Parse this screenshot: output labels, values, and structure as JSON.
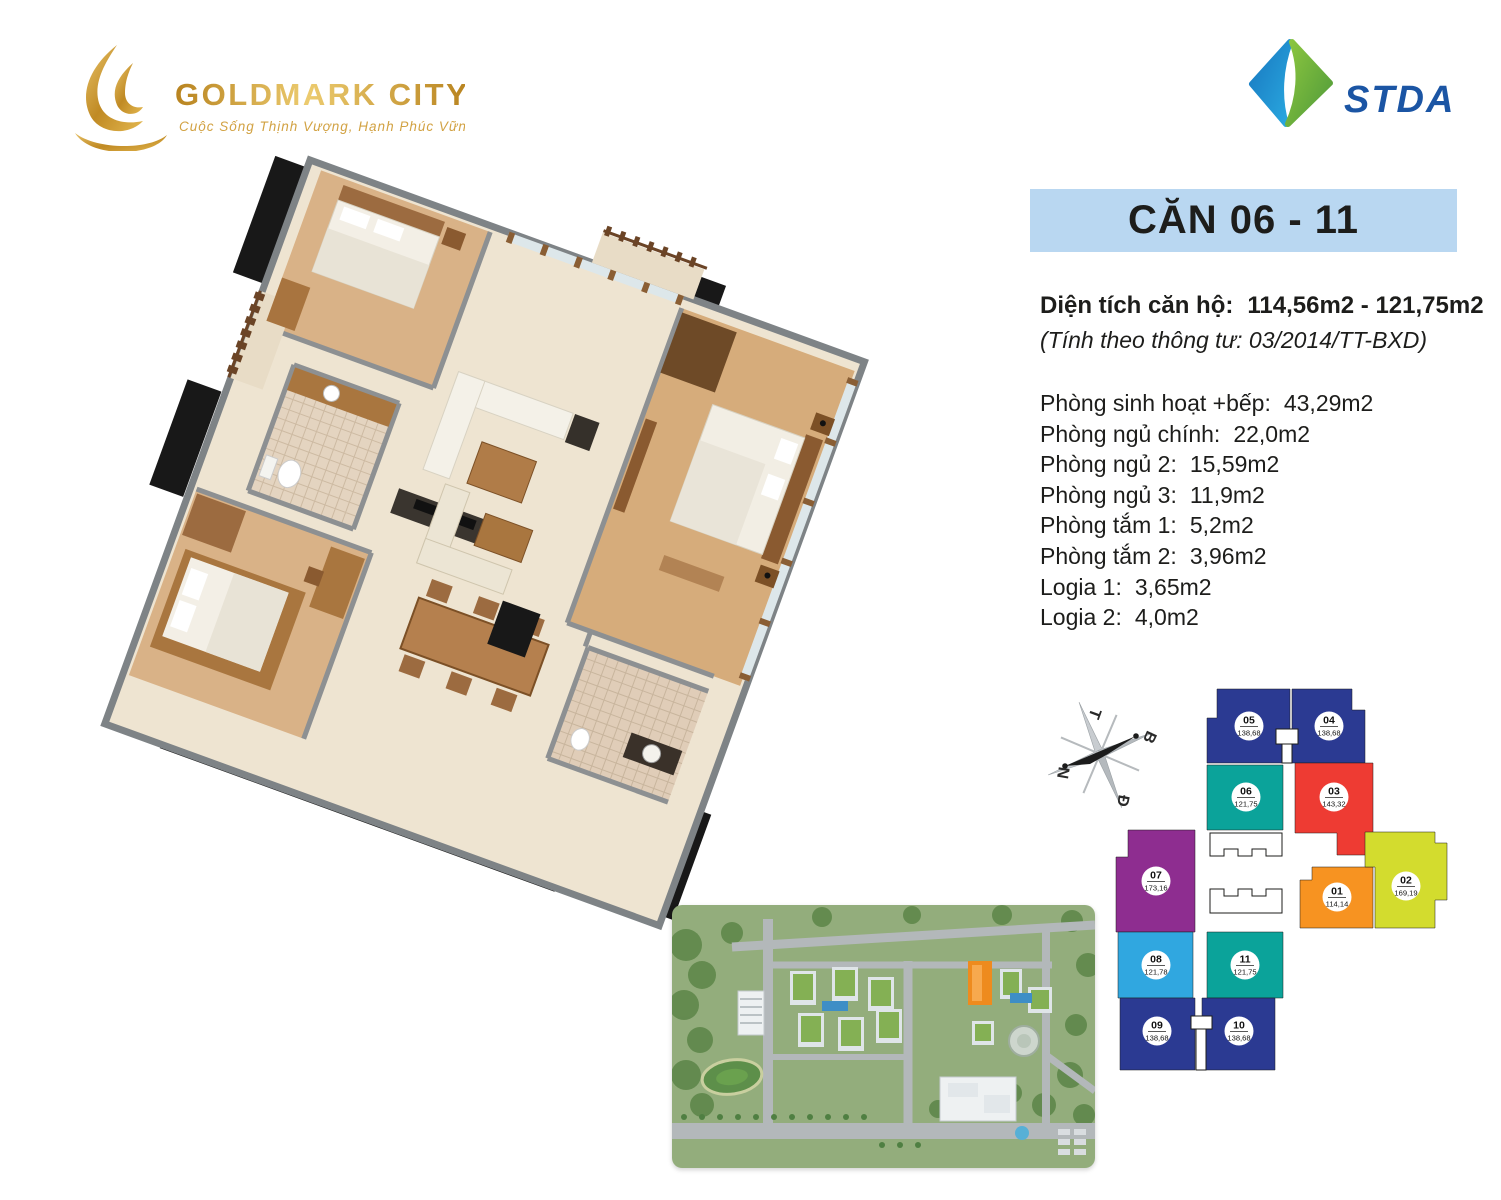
{
  "branding": {
    "goldmark": {
      "name": "GOLDMARK CITY",
      "tagline": "Cuộc Sống Thịnh Vượng, Hạnh Phúc Vững Bền",
      "gold": "#c9952c"
    },
    "stda": {
      "name": "STDA",
      "blue": "#1b55a4"
    }
  },
  "unit_header": {
    "title": "CĂN 06 - 11",
    "bg_color": "#b9d7f1"
  },
  "area_summary": {
    "label": "Diện tích căn hộ:",
    "value": "114,56m2 - 121,75m2",
    "note": "(Tính theo thông tư: 03/2014/TT-BXD)"
  },
  "room_areas": [
    {
      "label": "Phòng sinh hoạt +bếp:",
      "value": "43,29m2"
    },
    {
      "label": "Phòng ngủ chính:",
      "value": "22,0m2"
    },
    {
      "label": "Phòng ngủ 2:",
      "value": "15,59m2"
    },
    {
      "label": "Phòng ngủ 3:",
      "value": "11,9m2"
    },
    {
      "label": "Phòng tắm 1:",
      "value": "5,2m2"
    },
    {
      "label": "Phòng tắm 2:",
      "value": "3,96m2"
    },
    {
      "label": "Logia 1:",
      "value": "3,65m2"
    },
    {
      "label": "Logia 2:",
      "value": "4,0m2"
    }
  ],
  "compass": {
    "t": "T",
    "b": "B",
    "n": "N",
    "d": "Đ"
  },
  "floorplate": {
    "units": [
      {
        "no": "05",
        "area": "138,68",
        "color": "#2b3a92"
      },
      {
        "no": "04",
        "area": "138,68",
        "color": "#2b3a92"
      },
      {
        "no": "06",
        "area": "121,75",
        "color": "#0ba39a"
      },
      {
        "no": "03",
        "area": "143,32",
        "color": "#ee3b33"
      },
      {
        "no": "07",
        "area": "173,16",
        "color": "#8e2d90"
      },
      {
        "no": "01",
        "area": "114,14",
        "color": "#f79321"
      },
      {
        "no": "02",
        "area": "169,19",
        "color": "#d3dc2e"
      },
      {
        "no": "08",
        "area": "121,78",
        "color": "#30a7e0"
      },
      {
        "no": "11",
        "area": "121,75",
        "color": "#0ba39a"
      },
      {
        "no": "09",
        "area": "138,68",
        "color": "#2b3a92"
      },
      {
        "no": "10",
        "area": "138,68",
        "color": "#2b3a92"
      }
    ]
  }
}
